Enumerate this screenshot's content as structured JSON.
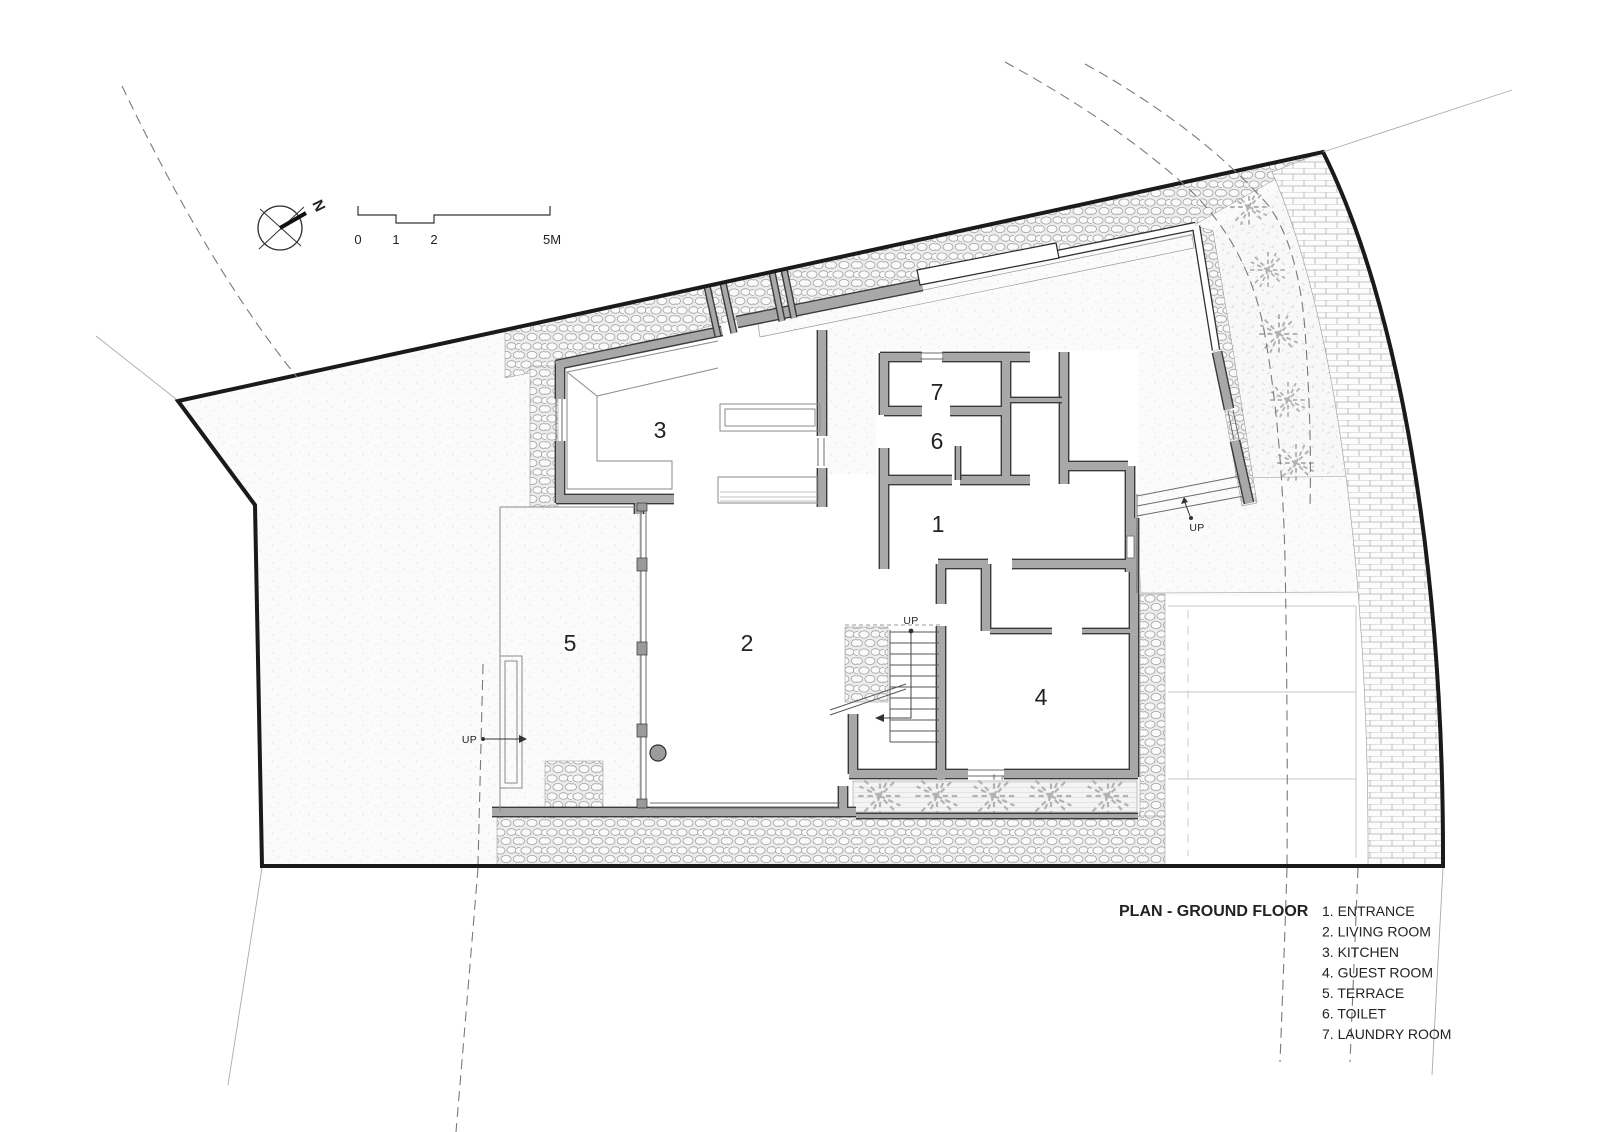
{
  "title_block": {
    "title": "PLAN - GROUND FLOOR"
  },
  "legend": {
    "items": [
      "1. ENTRANCE",
      "2. LIVING ROOM",
      "3. KITCHEN",
      "4. GUEST ROOM",
      "5. TERRACE",
      "6. TOILET",
      "7. LAUNDRY ROOM"
    ]
  },
  "rooms": [
    {
      "number": "1",
      "name": "ENTRANCE"
    },
    {
      "number": "2",
      "name": "LIVING ROOM"
    },
    {
      "number": "3",
      "name": "KITCHEN"
    },
    {
      "number": "4",
      "name": "GUEST ROOM"
    },
    {
      "number": "5",
      "name": "TERRACE"
    },
    {
      "number": "6",
      "name": "TOILET"
    },
    {
      "number": "7",
      "name": "LAUNDRY ROOM"
    }
  ],
  "annotations": {
    "up_label": "UP",
    "north_label": "N"
  },
  "scale_bar": {
    "tick_labels": [
      "0",
      "1",
      "2",
      "5M"
    ]
  },
  "colors": {
    "background": "#ffffff",
    "boundary": "#1a1a1a",
    "wall_fill": "#a8a8a8",
    "wall_outline": "#3a3a3a",
    "grid_line": "#c9c9c9"
  }
}
